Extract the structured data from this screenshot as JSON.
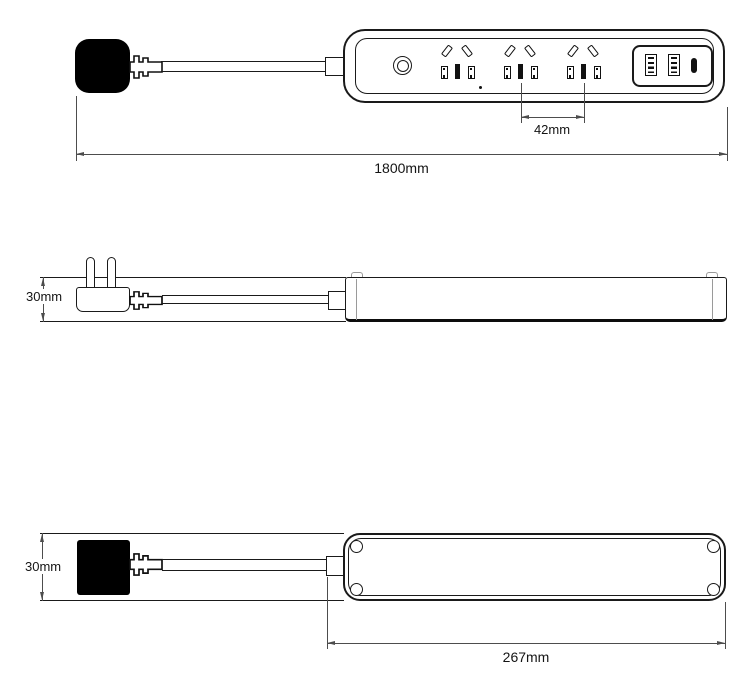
{
  "meta": {
    "title": "Power strip dimension drawing"
  },
  "labels": {
    "outlet_pitch": "42mm",
    "total_length": "1800mm",
    "height_side": "30mm",
    "height_bottom": "30mm",
    "body_length": "267mm"
  },
  "components": {
    "views": [
      "top-face-view",
      "side-profile-view",
      "bottom-view"
    ],
    "outlet_count": 3,
    "usb_a_count": 2,
    "usb_c_count": 1,
    "icons": [
      "power-button-icon",
      "socket-outlet-icon",
      "usb-a-port-icon",
      "usb-c-port-icon",
      "mains-plug-icon",
      "screw-hole-icon"
    ]
  },
  "colors": {
    "line": "#1a1a1a",
    "dimension_line": "#4d4d4d",
    "plug_fill": "#000000",
    "background": "#ffffff"
  }
}
